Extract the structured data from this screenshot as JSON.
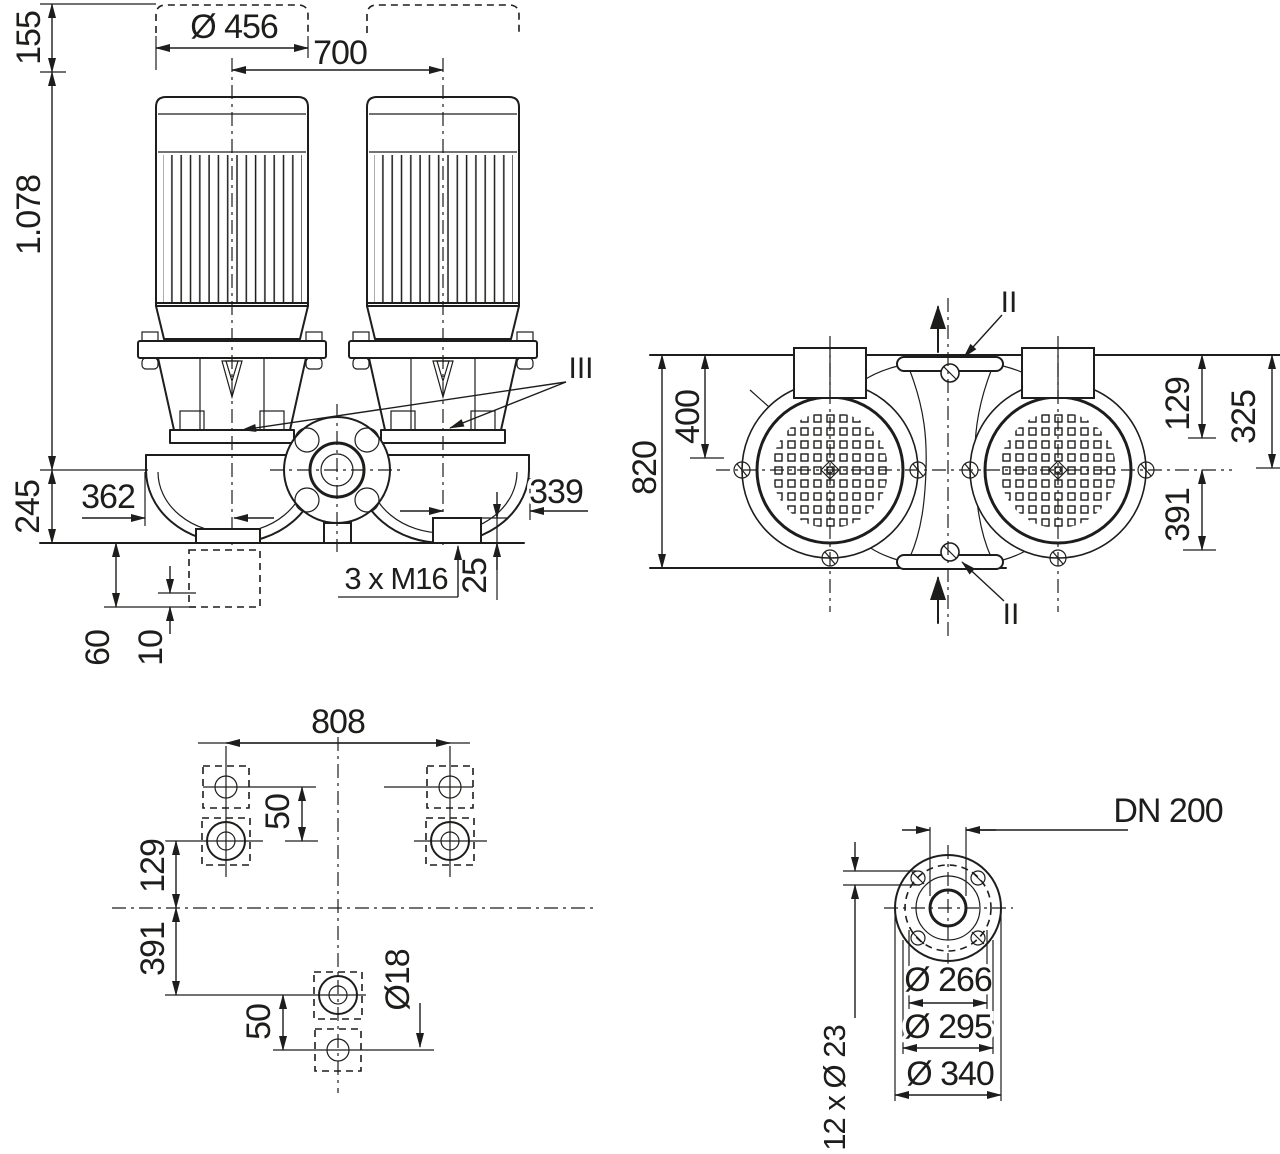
{
  "front_view": {
    "clearance_top": "155",
    "total_height": "1.078",
    "base_height": "245",
    "motor_diameter": "Ø 456",
    "motor_spacing": "700",
    "left_offset": "362",
    "right_offset": "339",
    "boss_height": "25",
    "anchor_bolts": "3 x M16",
    "pedestal_height": "60",
    "shim_height": "10",
    "section_marker": "III"
  },
  "top_view": {
    "port_to_port": "820",
    "face_to_axis": "400",
    "upper_offset": "129",
    "flange_offset": "325",
    "lower_offset": "391",
    "section_marker_top": "II",
    "section_marker_bottom": "II"
  },
  "foot_plan": {
    "bolt_span": "808",
    "slot_top": "50",
    "upper_offset": "129",
    "lower_offset": "391",
    "slot_bottom": "50",
    "hole_diameter": "Ø18"
  },
  "flange_view": {
    "nominal_diameter": "DN 200",
    "bolt_circle": "Ø 266",
    "raised_face": "Ø 295",
    "outer_diameter": "Ø 340",
    "bolt_holes": "12 x Ø 23"
  },
  "colors": {
    "line": "#1d1d1b",
    "background": "#ffffff"
  }
}
